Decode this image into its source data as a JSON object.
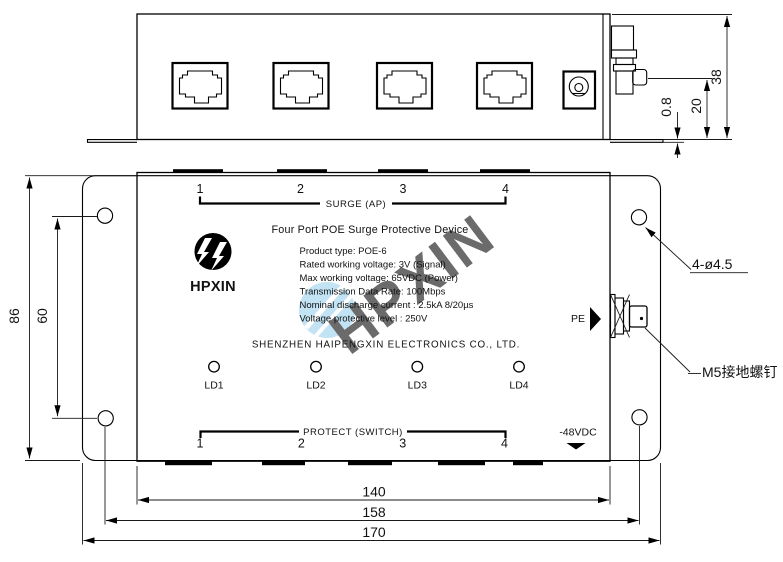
{
  "watermark": "HPXIN",
  "top_view": {
    "dim_total_height": "38",
    "dim_screw_height": "20",
    "dim_flange_thickness": "0.8"
  },
  "front_view": {
    "surge_numbers": [
      "1",
      "2",
      "3",
      "4"
    ],
    "surge_label": "SURGE  (AP)",
    "title": "Four Port POE Surge Protective Device",
    "logo_text": "HPXIN",
    "specs": [
      "Product type: POE-6",
      "Rated working voltage: 3V (Signal)",
      "Max working voltage: 65VDC (Power)",
      "Transmission Data Rate: 100Mbps",
      "Nominal discharge current : 2.5kA 8/20µs",
      "Voltage protective level : 250V"
    ],
    "company": "SHENZHEN HAIPENGXIN ELECTRONICS CO., LTD.",
    "led_labels": [
      "LD1",
      "LD2",
      "LD3",
      "LD4"
    ],
    "protect_label": "PROTECT  (SWITCH)",
    "protect_numbers": [
      "1",
      "2",
      "3",
      "4"
    ],
    "pe_label": "PE",
    "power_label": "-48VDC",
    "dim_height": "86",
    "dim_hole_spacing_vertical": "60",
    "dim_body_width": "140",
    "dim_hole_spacing_horizontal": "158",
    "dim_total_width": "170",
    "annotation_holes": "4-ø4.5",
    "annotation_ground_screw": "M5接地螺钉"
  }
}
